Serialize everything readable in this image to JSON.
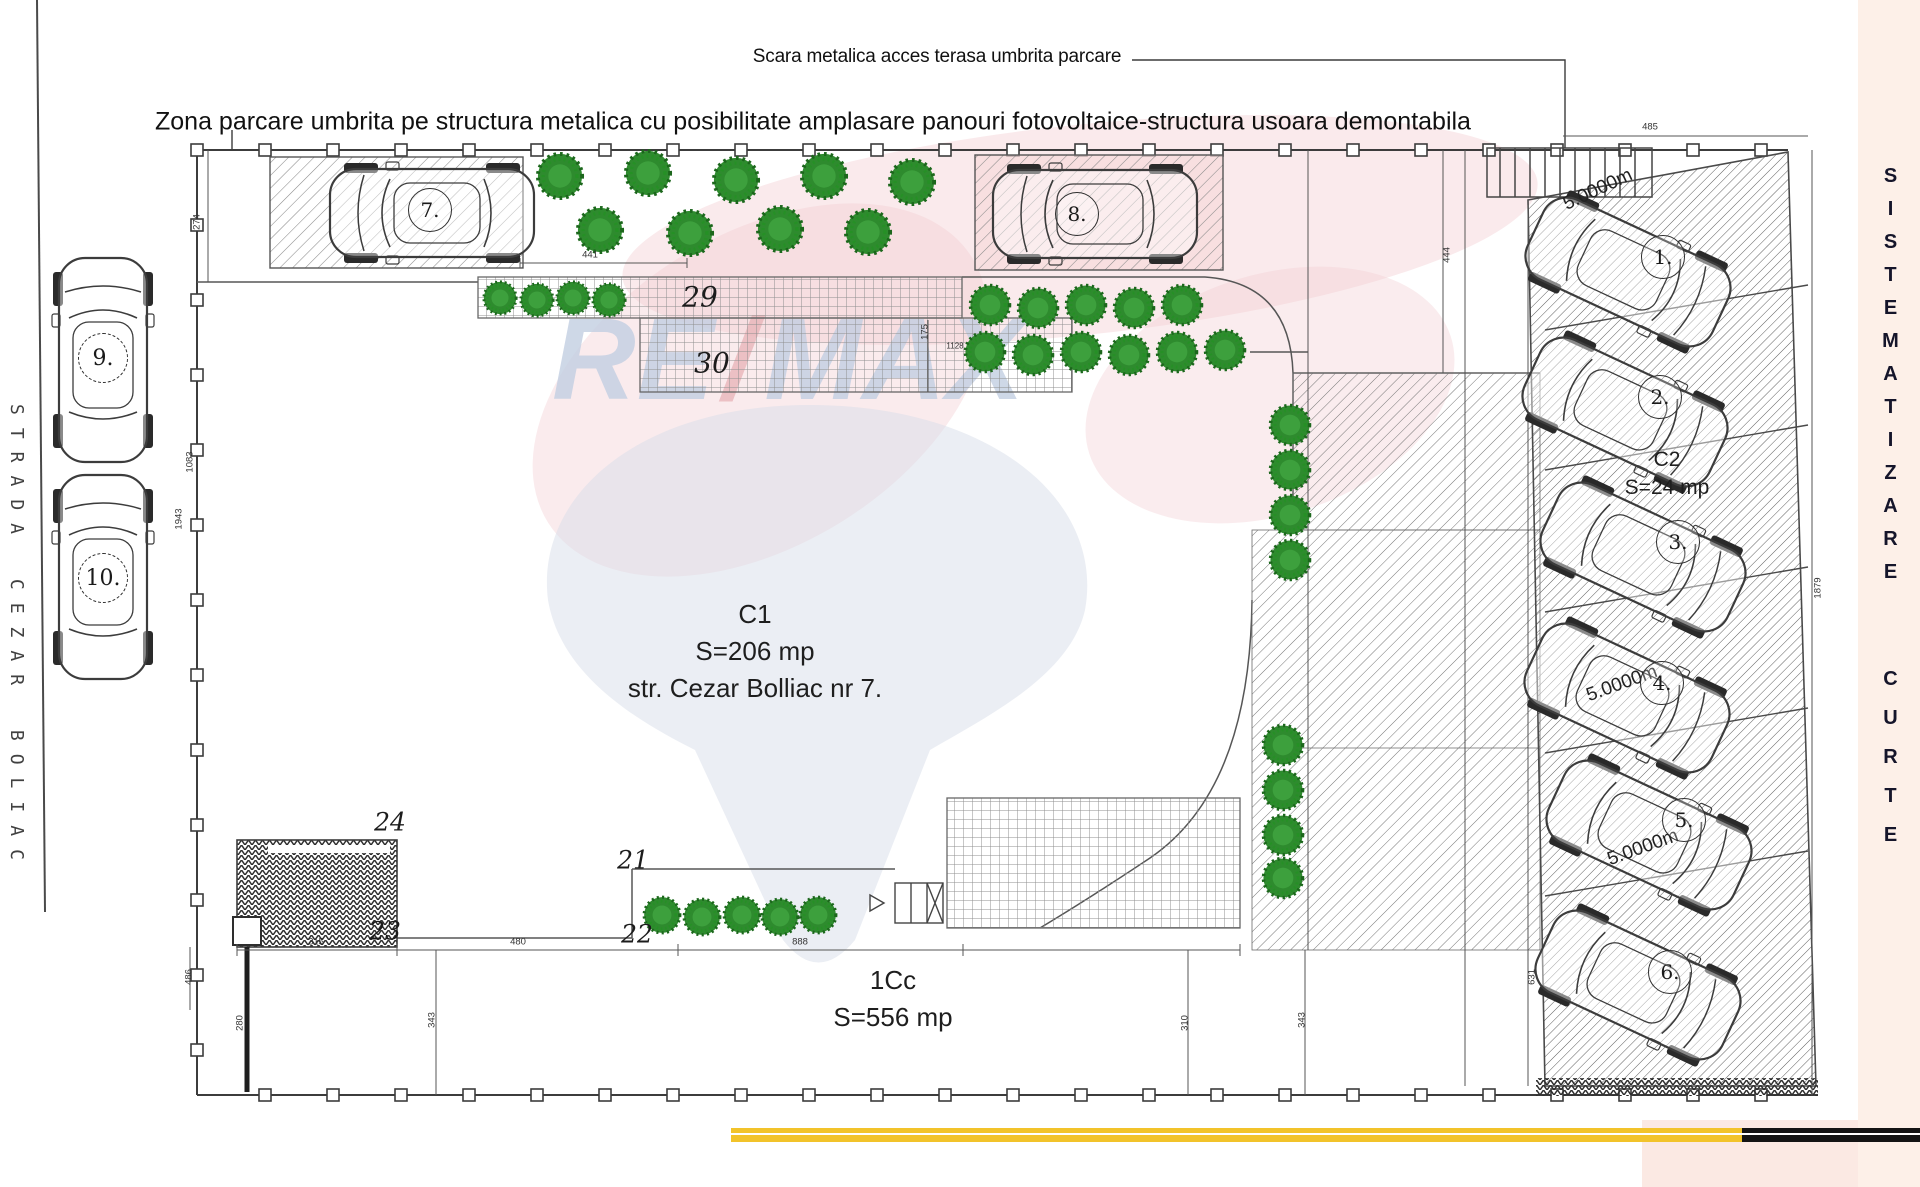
{
  "notes": {
    "stairs_note": "Scara metalica acces terasa umbrita parcare",
    "canopy_note": "Zona parcare umbrita pe structura metalica cu posibilitate amplasare panouri fotovoltaice-structura usoara demontabila"
  },
  "streets": {
    "left_street": "STRADA CEZAR BOLIAC"
  },
  "side_label": {
    "word1": "SISTEMATIZARE",
    "word2": "CURTE"
  },
  "zones": {
    "c1": {
      "name": "C1",
      "area": "S=206 mp",
      "address": "str. Cezar Bolliac nr 7."
    },
    "c2": {
      "name": "C2",
      "area": "S=24 mp"
    },
    "cc": {
      "name": "1Cc",
      "area": "S=556 mp"
    }
  },
  "parking": {
    "spots": [
      "1.",
      "2.",
      "3.",
      "4.",
      "5.",
      "6.",
      "7.",
      "8.",
      "9.",
      "10."
    ],
    "length_labels": [
      "5.0000m",
      "5.0000m",
      "5.0000m"
    ]
  },
  "markers": [
    "21",
    "22",
    "23",
    "24",
    "29",
    "30"
  ],
  "dims": {
    "d441": "441",
    "d444": "444",
    "d485": "485",
    "d274": "274",
    "d175": "175",
    "d1128": "1128",
    "d315": "315",
    "d480": "480",
    "d888": "888",
    "d343a": "343",
    "d343b": "343",
    "d310": "310",
    "d280": "280",
    "d486": "486",
    "d631": "631",
    "d1879": "1879",
    "d1083": "1083",
    "d1943": "1943"
  },
  "watermark": {
    "re": "RE",
    "slash": "/",
    "max": "MAX"
  },
  "colors": {
    "yellow_bar": "#f2c32a",
    "black_bar": "#141414",
    "side_strip": "#fdf0e8",
    "corner_panel": "#fbe9e3",
    "bush": "#2e8b2e",
    "watermark_blue": "#c3cfe2",
    "watermark_pink": "#f3ced2",
    "ink": "#3f3f3f"
  }
}
